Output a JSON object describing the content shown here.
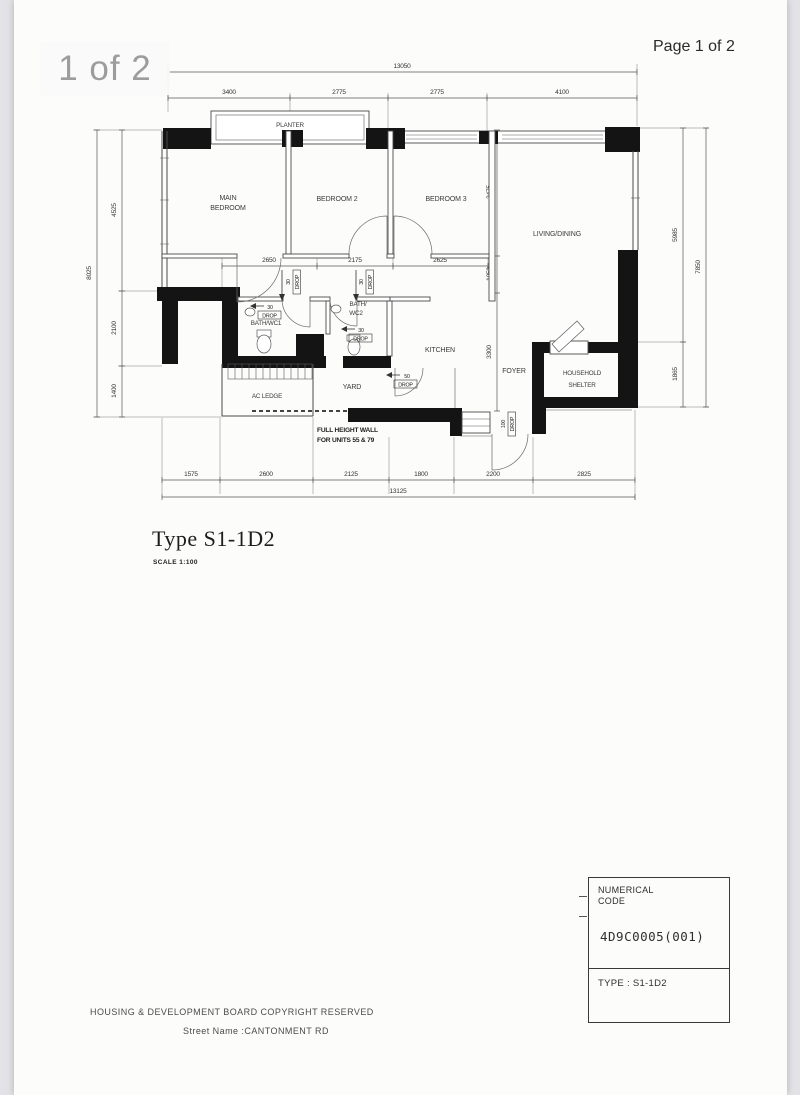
{
  "viewer": {
    "badge": "1 of 2",
    "page_indicator": "Page 1 of 2"
  },
  "plan": {
    "title": "Type S1-1D2",
    "scale": "SCALE 1:100",
    "rooms": {
      "planter": "PLANTER",
      "main_bedroom": [
        "MAIN",
        "BEDROOM"
      ],
      "bedroom2": "BEDROOM 2",
      "bedroom3": "BEDROOM 3",
      "living_dining": "LIVING/DINING",
      "bath_wc1": "BATH/WC1",
      "bath_wc2": [
        "BATH/",
        "WC2"
      ],
      "kitchen": "KITCHEN",
      "yard": "YARD",
      "ac_ledge": "AC LEDGE",
      "foyer": "FOYER",
      "household_shelter": [
        "HOUSEHOLD",
        "SHELTER"
      ]
    },
    "dims": {
      "top_total": "13050",
      "top": [
        "3400",
        "2775",
        "2775",
        "4100"
      ],
      "left_total": "8025",
      "left": [
        "4525",
        "2100",
        "1400"
      ],
      "mid_h": [
        "2650",
        "2175",
        "2625"
      ],
      "mid_v": [
        "3475",
        "1050",
        "3300"
      ],
      "right": [
        "5985",
        "1865"
      ],
      "right_total": "7850",
      "bottom": [
        "1575",
        "2600",
        "2125",
        "1800",
        "2200",
        "2825"
      ],
      "bottom_total": "13125"
    },
    "annotations": {
      "full_height_wall": [
        "FULL HEIGHT WALL",
        "FOR UNITS 55 & 79"
      ],
      "drop30": [
        "30",
        "DROP"
      ],
      "drop50": [
        "50",
        "DROP"
      ],
      "drop100": [
        "100",
        "DROP"
      ]
    }
  },
  "title_block": {
    "header": [
      "NUMERICAL",
      "CODE"
    ],
    "code": "4D9C0005(001)",
    "type_row": "TYPE : S1-1D2"
  },
  "footer": {
    "line1": "HOUSING & DEVELOPMENT BOARD  COPYRIGHT RESERVED",
    "line2": "Street Name :CANTONMENT RD"
  }
}
